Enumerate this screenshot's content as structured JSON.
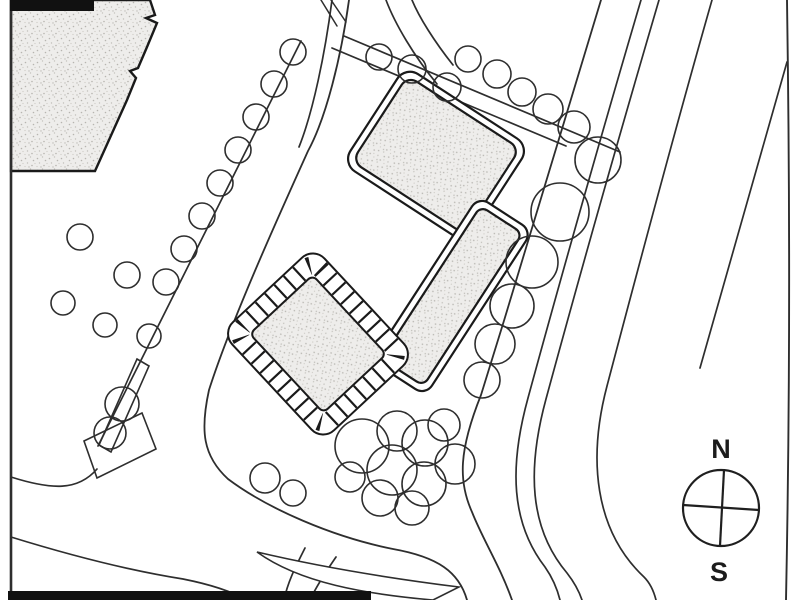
{
  "compass": {
    "north": "N",
    "south": "S",
    "cx": 721,
    "cy": 508,
    "r": 38
  },
  "colors": {
    "ink": "#2e2e2e",
    "ink_dark": "#1a1a1a",
    "paper": "#ffffff",
    "stipple_bg": "#eeedeb",
    "stipple_dot": "#b7b5b0",
    "bar": "#111111"
  },
  "drawing": {
    "bars": [
      {
        "x": 10,
        "y": 0,
        "w": 84,
        "h": 11
      },
      {
        "x": 8,
        "y": 591,
        "w": 363,
        "h": 9
      }
    ],
    "building_a_path": "M 11 0 L 150 0 L 155 15 L 146 18 L 157 23 L 147 47 L 138 68 L 130 71 L 136 78 L 127 100 L 95 171 L 11 171 Z",
    "buildings": [
      {
        "name": "building-north",
        "type": "double",
        "cx": 436,
        "cy": 155,
        "rot": 33,
        "w": 148,
        "h": 116,
        "rx": 15,
        "inset": 7
      },
      {
        "name": "building-east",
        "type": "double",
        "cx": 452,
        "cy": 296,
        "rot": 33,
        "w": 64,
        "h": 196,
        "rx": 12,
        "inset": 7
      },
      {
        "name": "building-west-banded",
        "type": "band",
        "cx": 318,
        "cy": 344,
        "rot": 47,
        "w": 148,
        "h": 126,
        "rx": 16,
        "band": 18,
        "mid_w": 128,
        "mid_h": 106,
        "mid_rx": 11,
        "in_w": 108,
        "in_h": 86,
        "in_rx": 6
      }
    ],
    "roads": [
      {
        "d": "M 11 0 L 11 599",
        "w": 2.6
      },
      {
        "d": "M 301 41 L 98 446",
        "w": 1.7
      },
      {
        "d": "M 349 0 C 341 58 326 118 308 151 C 280 213 231 321 209 390 C 200 431 203 456 228 479 C 268 509 333 537 393 549 C 438 557 459 572 467 600",
        "w": 1.8
      },
      {
        "d": "M 332 0 C 325 54 313 112 299 147",
        "w": 1.7
      },
      {
        "d": "M 386 0 C 395 24 414 56 437 84",
        "w": 1.7
      },
      {
        "d": "M 412 0 C 419 17 434 41 453 65",
        "w": 1.7
      },
      {
        "d": "M 344 36 L 620 152",
        "w": 1.7
      },
      {
        "d": "M 332 48 L 566 146",
        "w": 1.7
      },
      {
        "d": "M 601 0 C 565 120 523 260 481 395 C 459 450 458 481 472 512 C 483 540 500 566 512 600",
        "w": 1.8
      },
      {
        "d": "M 641 0 C 602 132 556 295 528 398 C 509 467 511 523 545 567 C 552 577 557 588 560 600",
        "w": 1.7
      },
      {
        "d": "M 659 0 C 620 133 574 296 546 399 C 527 469 529 528 567 573 C 574 582 579 591 582 600",
        "w": 1.7
      },
      {
        "d": "M 712 0 C 676 126 636 276 607 386 C 588 458 594 530 644 577 C 650 583 654 592 656 600",
        "w": 1.7
      },
      {
        "d": "M 787 0 C 790 200 790 400 786 600",
        "w": 1.9
      },
      {
        "d": "M 787 62 C 762 150 733 255 700 368",
        "w": 1.7
      },
      {
        "d": "M 11 477 C 52 490 78 491 97 469",
        "w": 1.7
      },
      {
        "d": "M 11 537 C 66 554 126 570 183 579 C 213 585 233 592 246 600",
        "w": 1.7
      },
      {
        "d": "M 305 548 C 296 566 288 581 284 600",
        "w": 1.7
      },
      {
        "d": "M 336 557 C 325 573 316 587 310 600",
        "w": 1.7
      },
      {
        "d": "M 321 0 L 337 26",
        "w": 1.5
      },
      {
        "d": "M 331 0 L 346 22",
        "w": 1.5
      }
    ],
    "polys": [
      {
        "name": "traffic-island",
        "d": "M 257 552 C 325 568 395 579 459 587 L 433 600 C 365 594 300 583 257 552 Z",
        "fill": "#ffffff"
      },
      {
        "name": "tree-pen",
        "d": "M 84 441 L 142 413 L 156 449 L 97 478 Z",
        "fill": "none"
      },
      {
        "name": "planter-strip",
        "d": "M 137 359 L 149 366 L 111 452 L 99 445 Z",
        "fill": "none"
      }
    ],
    "trees": [
      [
        293,
        52,
        13
      ],
      [
        274,
        84,
        13
      ],
      [
        256,
        117,
        13
      ],
      [
        238,
        150,
        13
      ],
      [
        220,
        183,
        13
      ],
      [
        202,
        216,
        13
      ],
      [
        184,
        249,
        13
      ],
      [
        166,
        282,
        13
      ],
      [
        122,
        404,
        17
      ],
      [
        110,
        433,
        16
      ],
      [
        80,
        237,
        13
      ],
      [
        127,
        275,
        13
      ],
      [
        63,
        303,
        12
      ],
      [
        105,
        325,
        12
      ],
      [
        149,
        336,
        12
      ],
      [
        379,
        57,
        13
      ],
      [
        412,
        69,
        14
      ],
      [
        447,
        87,
        14
      ],
      [
        468,
        59,
        13
      ],
      [
        497,
        74,
        14
      ],
      [
        522,
        92,
        14
      ],
      [
        548,
        109,
        15
      ],
      [
        574,
        127,
        16
      ],
      [
        598,
        160,
        23
      ],
      [
        560,
        212,
        29
      ],
      [
        532,
        262,
        26
      ],
      [
        512,
        306,
        22
      ],
      [
        495,
        344,
        20
      ],
      [
        482,
        380,
        18
      ],
      [
        362,
        446,
        27
      ],
      [
        397,
        431,
        20
      ],
      [
        425,
        443,
        23
      ],
      [
        392,
        470,
        25
      ],
      [
        424,
        484,
        22
      ],
      [
        455,
        464,
        20
      ],
      [
        380,
        498,
        18
      ],
      [
        412,
        508,
        17
      ],
      [
        444,
        425,
        16
      ],
      [
        350,
        477,
        15
      ],
      [
        265,
        478,
        15
      ],
      [
        293,
        493,
        13
      ]
    ]
  }
}
